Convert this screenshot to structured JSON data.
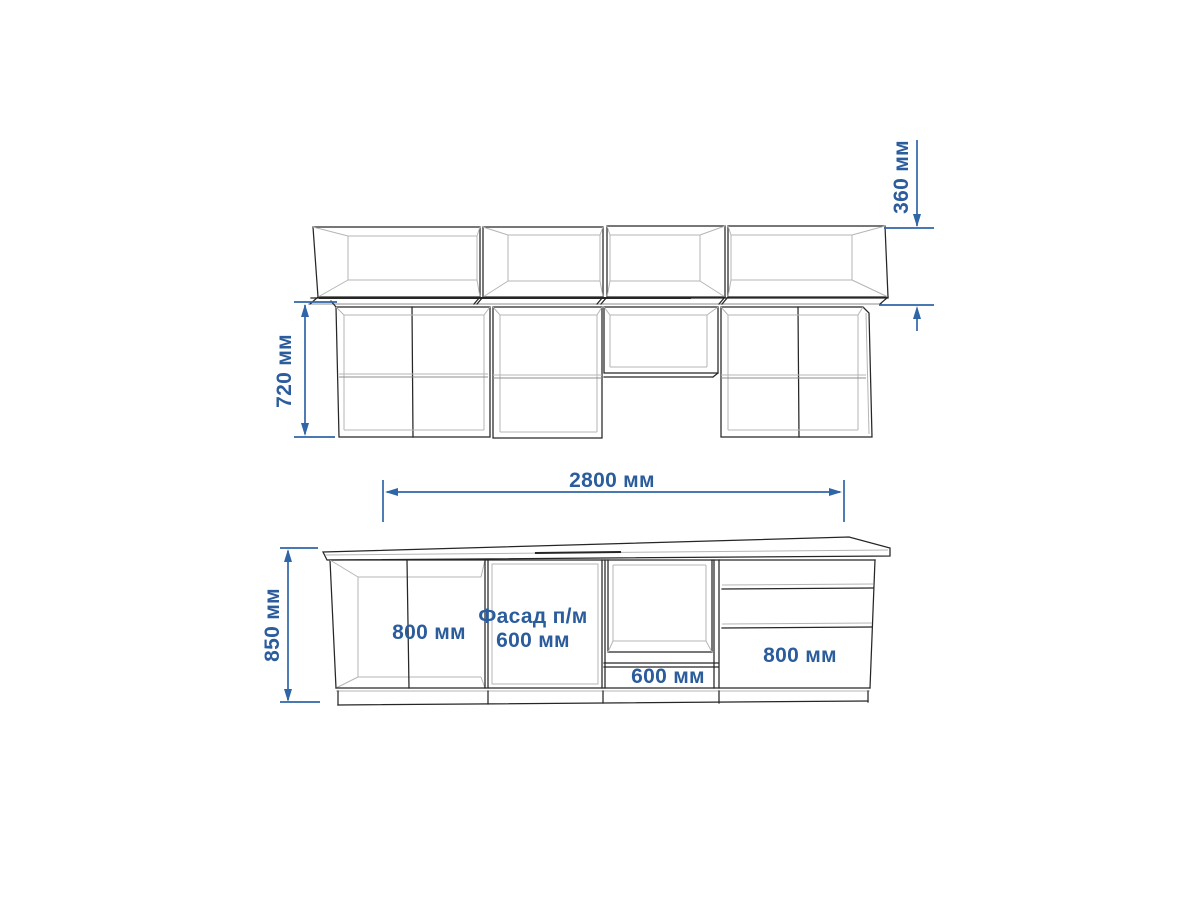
{
  "colors": {
    "background": "#ffffff",
    "line_dark": "#262626",
    "line_mid": "#8c8c8c",
    "line_light": "#b5b5b5",
    "dimension_line": "#2f66a8",
    "dimension_text": "#2b5c9c"
  },
  "labels": {
    "dim_360": "360 мм",
    "dim_720": "720 мм",
    "dim_2800": "2800 мм",
    "dim_850": "850 мм",
    "base_left_cabinet": "800 мм",
    "base_facade": "Фасад п/м 600 мм",
    "base_oven_niche": "600 мм",
    "base_drawer_cabinet": "800 мм"
  }
}
